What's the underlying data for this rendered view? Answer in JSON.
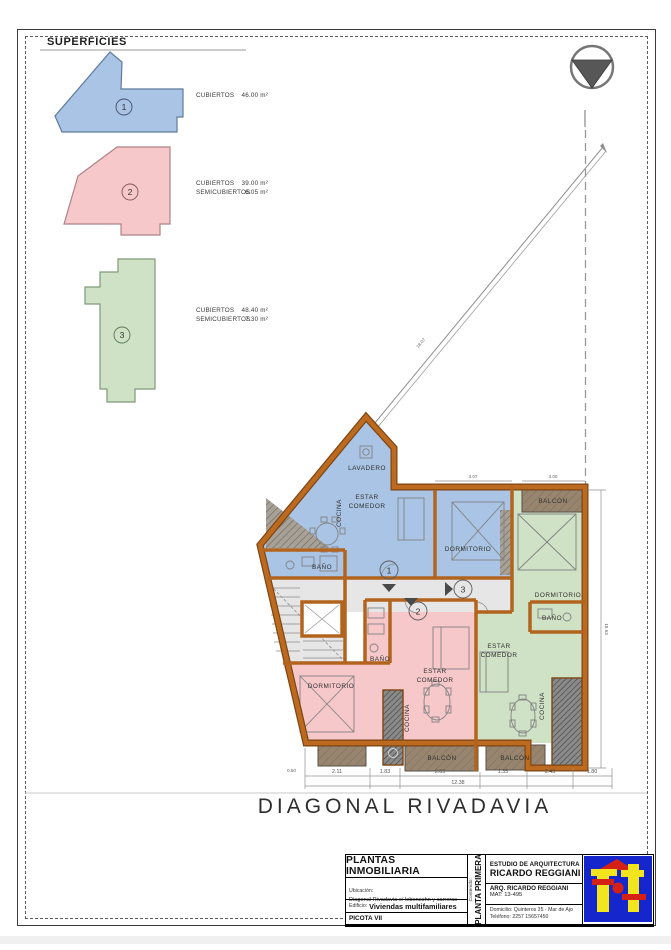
{
  "page": {
    "superficies_title": "SUPERFICIES",
    "street_name": "DIAGONAL RIVADAVIA"
  },
  "legend": {
    "units": [
      {
        "number": "1",
        "rows": [
          {
            "label": "CUBIERTOS",
            "value": "46.00 m²"
          }
        ]
      },
      {
        "number": "2",
        "rows": [
          {
            "label": "CUBIERTOS",
            "value": "39.00 m²"
          },
          {
            "label": "SEMICUBIERTOS",
            "value": "6.05 m²"
          }
        ]
      },
      {
        "number": "3",
        "rows": [
          {
            "label": "CUBIERTOS",
            "value": "48.40 m²"
          },
          {
            "label": "SEMICUBIERTOS",
            "value": "7.30 m²"
          }
        ]
      }
    ]
  },
  "plan": {
    "room_labels": {
      "lavadero": "LAVADERO",
      "estar": "ESTAR",
      "comedor": "COMEDOR",
      "cocina": "COCINA",
      "bano": "BAÑO",
      "dormitorio": "DORMITORIO",
      "balcon": "BALCÓN"
    },
    "unit_numbers": {
      "u1": "1",
      "u2": "2",
      "u3": "3"
    },
    "dimensions": {
      "bottom_segments": [
        "2.11",
        "1.83",
        "2.65",
        "1.35",
        "2.43",
        "1.80"
      ],
      "bottom_total": "12.38",
      "left_small": "0.50",
      "right_vertical": "18.63",
      "diagonal": "18.07",
      "top_left": "3.07",
      "top_right": "3.00"
    }
  },
  "title_block": {
    "title": "PLANTAS INMOBILIARIA",
    "ubicacion_label": "Ubicación:",
    "ubicacion_value": "Diagonal Rivadavia e/ lebensohn y carreras",
    "edificio_label": "Edificio:",
    "edificio_value": "Viviendas multifamiliares",
    "project_code": "PICOTA VII",
    "contenido_label": "Contenido:",
    "contenido_value": "PLANTA PRIMERA",
    "studio_line1": "ESTUDIO DE ARQUITECTURA",
    "studio_line2": "RICARDO REGGIANI",
    "architect": "ARQ. RICARDO REGGIANI",
    "matricula": "MAT: 13-495",
    "domicilio": "Domicilio: Quinteros 35 - Mar de Ajo",
    "telefono": "Teléfono: 2257 15657450"
  },
  "colors": {
    "unit1_fill": "#a9c4e4",
    "unit2_fill": "#f6c8ca",
    "unit3_fill": "#cfe2c6",
    "wall": "#b2641e",
    "balcony": "#97856f",
    "hall": "#e6e6e6",
    "logo_blue": "#1526cc",
    "logo_yellow": "#f2e51e",
    "logo_red": "#d42015"
  }
}
